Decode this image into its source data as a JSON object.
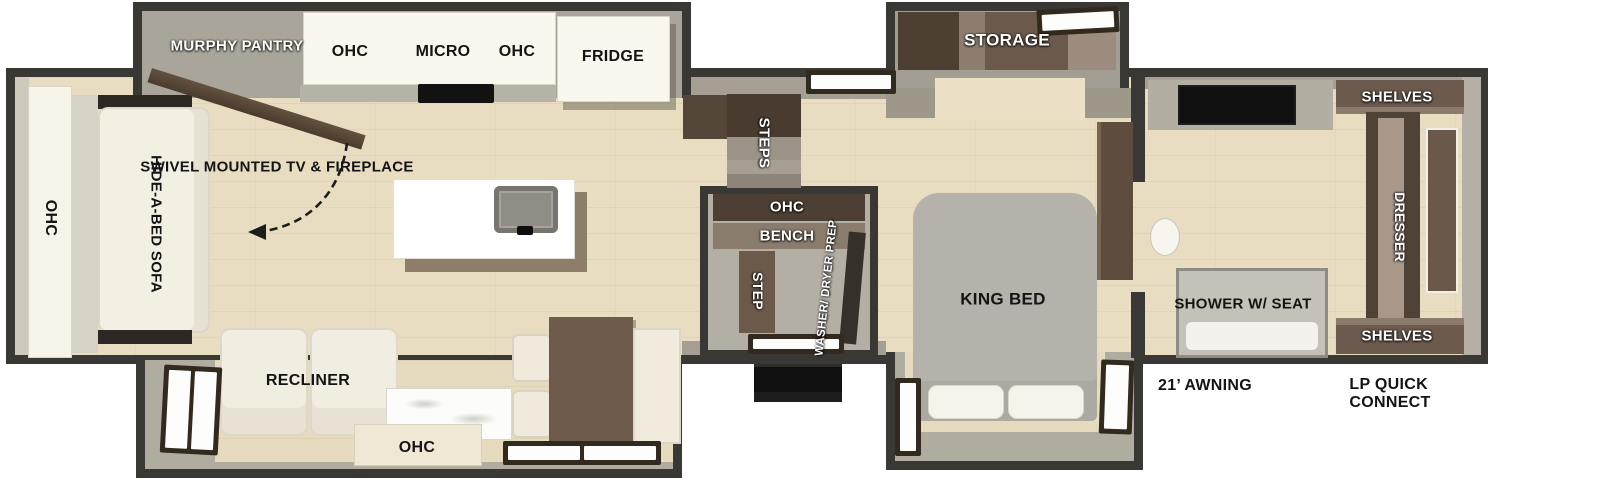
{
  "floorplan": {
    "rear_living": {
      "ohc_side": "OHC",
      "hide_a_bed_line1": "HIDE-A-BED",
      "hide_a_bed_line2": "SOFA",
      "murphy_line1": "MURPHY",
      "murphy_line2": "PANTRY",
      "swivel_line1": "SWIVEL",
      "swivel_line2": "MOUNTED TV",
      "swivel_line3": "& FIREPLACE",
      "recliner": "RECLINER",
      "ohc_bottom": "OHC"
    },
    "kitchen": {
      "ohc_left": "OHC",
      "micro": "MICRO",
      "ohc_right": "OHC",
      "fridge": "FRIDGE"
    },
    "mid": {
      "steps": "STEPS",
      "ohc": "OHC",
      "bench": "BENCH",
      "step": "STEP",
      "washer_line1": "WASHER/",
      "washer_line2": "DRYER",
      "washer_line3": "PREP"
    },
    "bedroom": {
      "storage": "STORAGE",
      "king_line1": "KING",
      "king_line2": "BED"
    },
    "front": {
      "shelves_top": "SHELVES",
      "dresser": "DRESSER",
      "shelves_bottom": "SHELVES",
      "shower_line1": "SHOWER",
      "shower_line2": "W/ SEAT"
    },
    "exterior": {
      "awning": "21’ AWNING",
      "lp_line1": "LP QUICK",
      "lp_line2": "CONNECT"
    }
  },
  "colors": {
    "wall": "#3a3835",
    "floor": "#e8ddc1",
    "slide_interior": "#a9a59a",
    "cabinet_dark_brown": "#4e3f34",
    "cabinet_mid_brown": "#6b5a4c",
    "furniture_white": "#f3efe3",
    "bed_gray": "#b5b2ac"
  }
}
